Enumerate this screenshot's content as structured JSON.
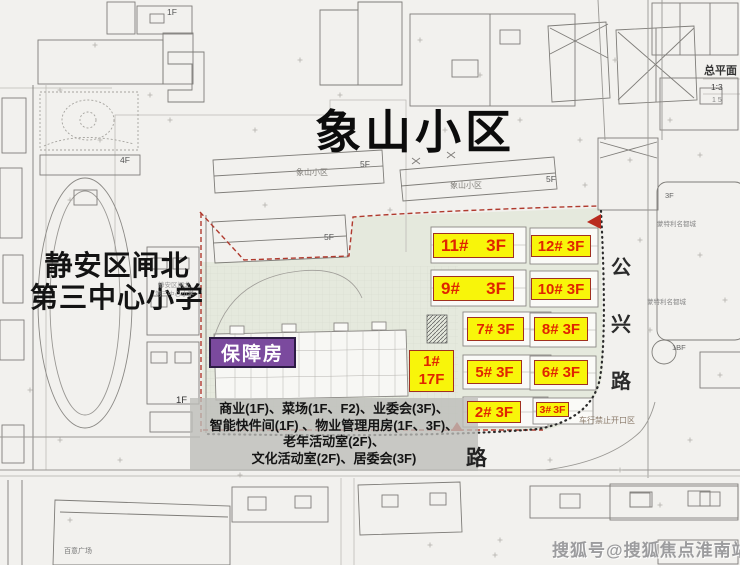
{
  "title": "象山小区",
  "school": {
    "line1": "静安区闸北",
    "line2": "第三中心小学"
  },
  "badges": {
    "baozhang": "保障房"
  },
  "building_labels": [
    {
      "num": "11#",
      "floors": "3F"
    },
    {
      "num": "12#",
      "floors": "3F"
    },
    {
      "num": "9#",
      "floors": "3F"
    },
    {
      "num": "10#",
      "floors": "3F"
    },
    {
      "num": "7#",
      "floors": "3F"
    },
    {
      "num": "8#",
      "floors": "3F"
    },
    {
      "num": "5#",
      "floors": "3F"
    },
    {
      "num": "6#",
      "floors": "3F"
    },
    {
      "num": "2#",
      "floors": "3F"
    },
    {
      "num": "3#",
      "floors": "3F"
    },
    {
      "num": "1#",
      "floors": "17F"
    }
  ],
  "facilities_lines": [
    "商业(1F)、菜场(1F、F2)、业委会(3F)、",
    "智能快件间(1F) 、物业管理用房(1F、3F)、",
    "老年活动室(2F)、",
    "文化活动室(2F)、居委会(3F)"
  ],
  "roads": {
    "vertical_road": "公兴路",
    "bottom_road": "路"
  },
  "map_labels": [
    "象山小区",
    "象山小区",
    "5F",
    "5F",
    "5F",
    "1F",
    "1F",
    "4F",
    "3F",
    "1BF",
    "蒙特利名都城",
    "蒙特利名都城",
    "百意广场",
    "静安区闸北",
    "第三中心小学",
    "车行禁止开口区",
    "总平面",
    "1∶3",
    "1  5"
  ],
  "watermark": "搜狐号@搜狐焦点淮南站",
  "colors": {
    "label_bg": "#f8f50a",
    "label_text": "#e02500",
    "baozhang_bg": "#7b4a9e",
    "boundary_red": "#b03a2e",
    "paper": "#f2f1ee"
  }
}
